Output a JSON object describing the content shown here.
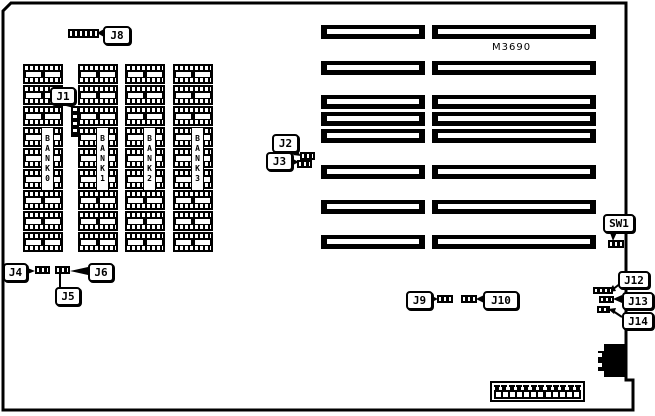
{
  "board": {
    "model_label": "M3690",
    "memory": {
      "columns": 4,
      "chips_per_column": 9,
      "bank_labels": [
        "BANK 0",
        "BANK 1",
        "BANK 2",
        "BANK 3"
      ]
    },
    "expansion_slots": {
      "rows": 8,
      "segments_per_row": 2
    },
    "callouts": {
      "j1": "J1",
      "j2": "J2",
      "j3": "J3",
      "j4": "J4",
      "j5": "J5",
      "j6": "J6",
      "j8": "J8",
      "j9": "J9",
      "j10": "J10",
      "j12": "J12",
      "j13": "J13",
      "j14": "J14",
      "sw1": "SW1"
    },
    "bottom_connector": {
      "pins": 12,
      "holes": 12
    }
  }
}
